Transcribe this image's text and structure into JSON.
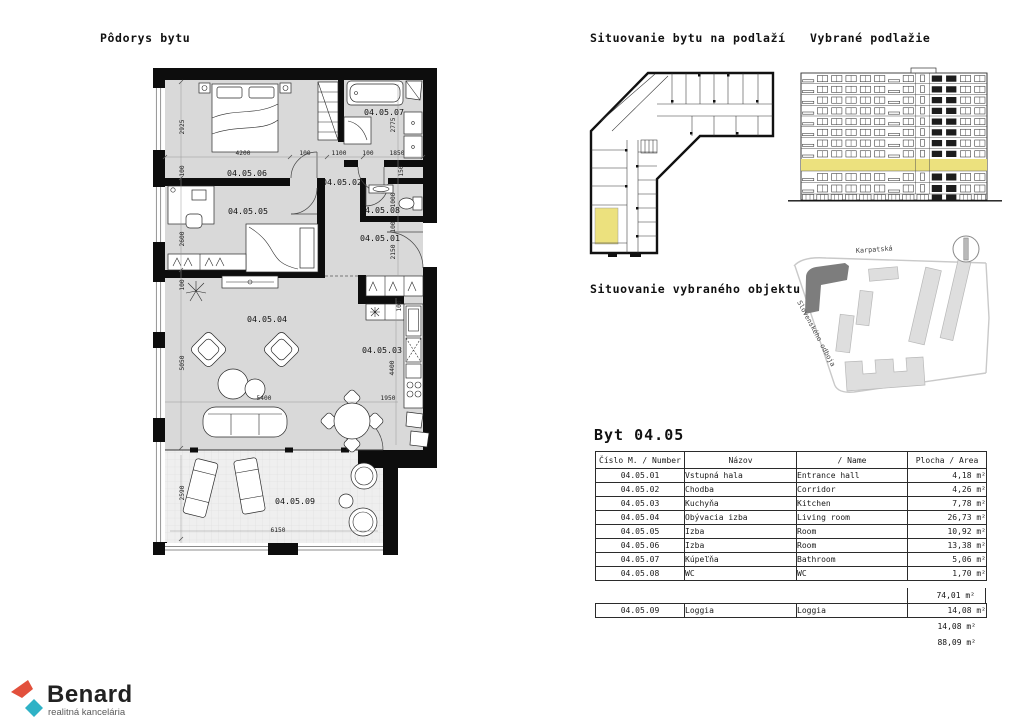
{
  "titles": {
    "floorplan": "Pôdorys bytu",
    "floor_situation": "Situovanie bytu na podlaží",
    "selected_floor": "Vybrané podlažie",
    "object_situation": "Situovanie vybraného objektu"
  },
  "floorplan": {
    "rooms": [
      "04.05.01",
      "04.05.02",
      "04.05.03",
      "04.05.04",
      "04.05.05",
      "04.05.06",
      "04.05.07",
      "04.05.08",
      "04.05.09"
    ],
    "dims": [
      "2925",
      "4200",
      "100",
      "100",
      "1100",
      "100",
      "1850",
      "2775",
      "150",
      "1000",
      "100",
      "2150",
      "2600",
      "100",
      "5050",
      "5400",
      "1950",
      "4400",
      "100",
      "2590",
      "6150"
    ]
  },
  "sitemap": {
    "street_top": "Karpatská",
    "street_left": "Slovenského odboja"
  },
  "apartment": {
    "title": "Byt 04.05",
    "headers": [
      "Číslo M. / Number",
      "Názov",
      "/ Name",
      "Plocha / Area"
    ],
    "rows": [
      [
        "04.05.01",
        "Vstupná hala",
        "Entrance hall",
        "4,18 m²"
      ],
      [
        "04.05.02",
        "Chodba",
        "Corridor",
        "4,26 m²"
      ],
      [
        "04.05.03",
        "Kuchyňa",
        "Kitchen",
        "7,78 m²"
      ],
      [
        "04.05.04",
        "Obývacia izba",
        "Living room",
        "26,73 m²"
      ],
      [
        "04.05.05",
        "Izba",
        "Room",
        "10,92 m²"
      ],
      [
        "04.05.06",
        "Izba",
        "Room",
        "13,38 m²"
      ],
      [
        "04.05.07",
        "Kúpeľňa",
        "Bathroom",
        "5,06 m²"
      ],
      [
        "04.05.08",
        "WC",
        "WC",
        "1,70 m²"
      ]
    ],
    "subtotal_rooms": "74,01 m²",
    "loggia_row": [
      "04.05.09",
      "Loggia",
      "Loggia",
      "14,08 m²"
    ],
    "subtotal_loggia": "14,08 m²",
    "total": "88,09 m²"
  },
  "logo": {
    "brand": "Benard",
    "tagline": "realitná kancelária"
  },
  "colors": {
    "highlight": "#ece17e",
    "logo_red": "#e2503c",
    "logo_teal": "#2fb2c6",
    "selected_building": "#7d7d7d"
  }
}
